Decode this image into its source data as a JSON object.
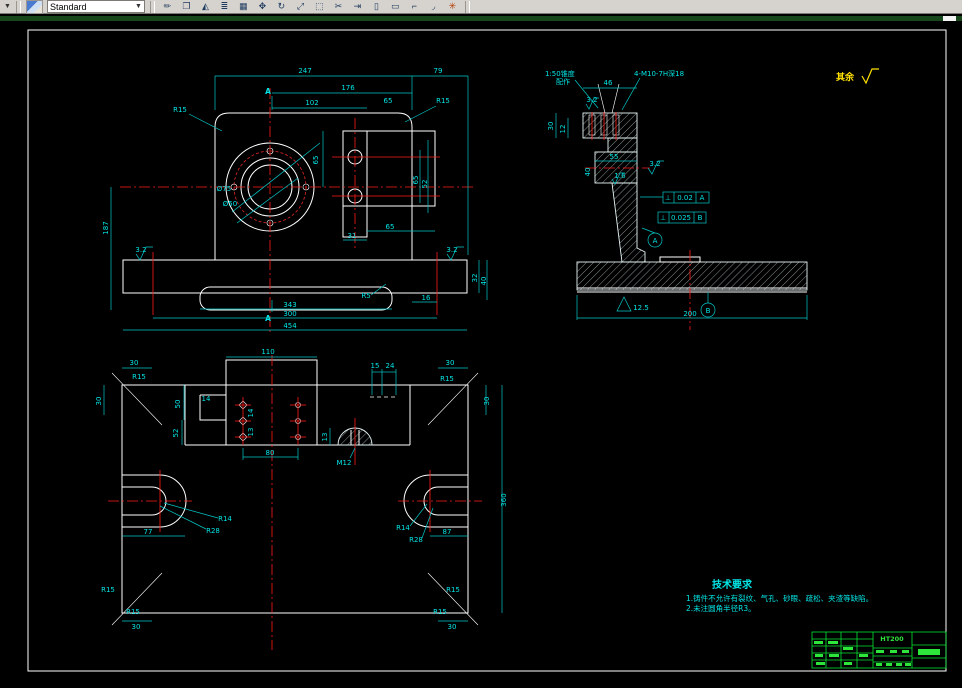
{
  "window": {
    "toolbar": {
      "standard": "Standard",
      "dropdown_glyph": "▼",
      "icons": [
        {
          "name": "erase",
          "glyph": "✏"
        },
        {
          "name": "copy",
          "glyph": "❐"
        },
        {
          "name": "mirror",
          "glyph": "◭"
        },
        {
          "name": "offset",
          "glyph": "≣"
        },
        {
          "name": "array",
          "glyph": "▦"
        },
        {
          "name": "move",
          "glyph": "✥"
        },
        {
          "name": "rotate",
          "glyph": "↻"
        },
        {
          "name": "scale",
          "glyph": "⤢"
        },
        {
          "name": "stretch",
          "glyph": "⬚"
        },
        {
          "name": "trim",
          "glyph": "✂"
        },
        {
          "name": "extend",
          "glyph": "⇥"
        },
        {
          "name": "break-at-point",
          "glyph": "▯"
        },
        {
          "name": "break",
          "glyph": "▭"
        },
        {
          "name": "chamfer",
          "glyph": "⌐"
        },
        {
          "name": "fillet",
          "glyph": "◞"
        },
        {
          "name": "explode",
          "glyph": "✳"
        }
      ]
    }
  },
  "drawing": {
    "rest_note": "其余",
    "front_view": {
      "dims": {
        "d247": "247",
        "d79": "79",
        "d176": "176",
        "d102": "102",
        "d65t": "65",
        "r15l": "R15",
        "r15r": "R15",
        "d65v": "65",
        "phi75": "Ø75",
        "phi50": "Ø50",
        "d65r": "65",
        "d52r": "52",
        "d187": "187",
        "sf_l": "3.2",
        "sf_r": "3.2",
        "d32": "32",
        "d40": "40",
        "d16": "16",
        "r5": "R5",
        "a_top": "A",
        "a_bot": "A",
        "d343": "343",
        "d300": "300",
        "d454": "454",
        "d31": "31",
        "d65b": "65"
      }
    },
    "section_view": {
      "note1a": "1:50锥度",
      "note1b": "配作",
      "note2": "4-M10-7H深18",
      "d46": "46",
      "d30": "30",
      "d12": "12",
      "sf32": "3.2",
      "sf32b": "3.2",
      "d55": "55",
      "sf16": "1.6",
      "d40": "40",
      "fcf1_sym": "⊥",
      "fcf1_val": "0.02",
      "fcf1_ref": "A",
      "fcf2_sym": "⊥",
      "fcf2_val": "0.025",
      "fcf2_ref": "B",
      "datum_a": "A",
      "datum_b": "B",
      "sf125": "12.5",
      "d200": "200"
    },
    "bottom_view": {
      "d110": "110",
      "d15": "15",
      "d24": "24",
      "d30tl": "30",
      "d30tr": "30",
      "d30l": "30",
      "d30r": "30",
      "d30bl": "30",
      "d30br": "30",
      "r15tl": "R15",
      "r15tr": "R15",
      "r15bl": "R15",
      "r15bl2": "R15",
      "r15br": "R15",
      "r15br2": "R15",
      "d360": "360",
      "d50": "50",
      "d52": "52",
      "d14": "14",
      "d14v": "14",
      "d13v": "13",
      "d13m": "13",
      "d80": "80",
      "m12": "M12",
      "r14l": "R14",
      "r28l": "R28",
      "r14r": "R14",
      "r28r": "R28",
      "d77": "77",
      "d87": "87"
    },
    "tech_req": {
      "title": "技术要求",
      "line1": "1.铸件不允许有裂纹、气孔、砂眼、疏松、夹渣等缺陷。",
      "line2": "2.未注圆角半径R3。"
    },
    "title_block": {
      "material": "HT200"
    },
    "colors": {
      "dimension": "#00e5e5",
      "geometry": "#ffffff",
      "centerline": "#ff1a1a",
      "annotation": "#ffe000",
      "table": "#2ee53c",
      "background": "#000000"
    }
  }
}
